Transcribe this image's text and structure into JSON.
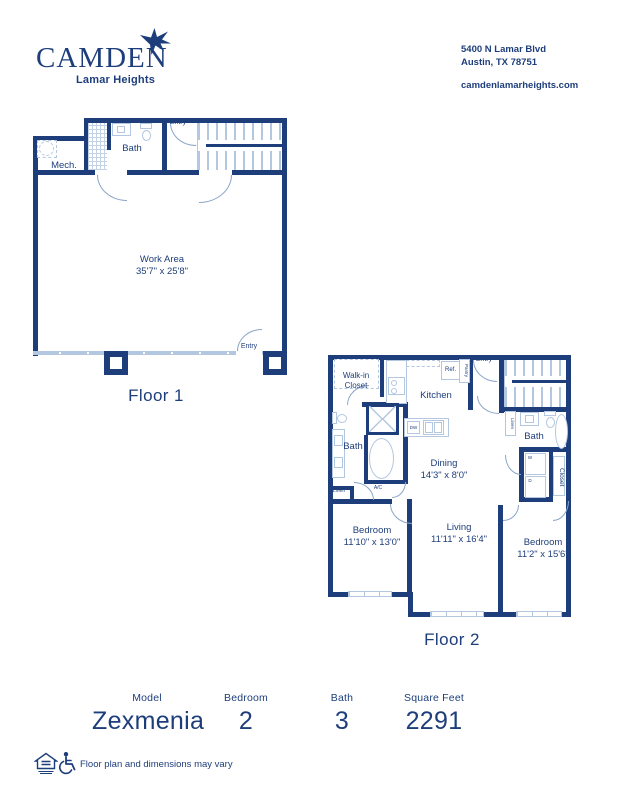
{
  "header": {
    "brand": "CAMDEN",
    "community": "Lamar Heights",
    "address_line1": "5400 N Lamar Blvd",
    "address_line2": "Austin, TX 78751",
    "website": "camdenlamarheights.com"
  },
  "floor1": {
    "title": "Floor 1",
    "mech": "Mech.",
    "bath": "Bath",
    "entry_top": "Entry",
    "entry_bottom": "Entry",
    "work_area_name": "Work Area",
    "work_area_dims": "35'7\" x 25'8\""
  },
  "floor2": {
    "title": "Floor 2",
    "walkin_line1": "Walk-in",
    "walkin_line2": "Closet",
    "kitchen": "Kitchen",
    "ref": "Ref.",
    "pantry": "Pantry",
    "entry": "Entry",
    "bath_left": "Bath",
    "bath_right": "Bath",
    "linen_left": "Linen",
    "linen_right": "Linen",
    "ac": "A/C",
    "dw": "DW",
    "washer": "W",
    "dryer": "D",
    "closet": "Closet",
    "dining_name": "Dining",
    "dining_dims": "14'3\" x 8'0\"",
    "living_name": "Living",
    "living_dims": "11'11\" x 16'4\"",
    "bedroom1_name": "Bedroom",
    "bedroom1_dims": "11'10\" x 13'0\"",
    "bedroom2_name": "Bedroom",
    "bedroom2_dims": "11'2\" x 15'6\""
  },
  "summary": {
    "model_label": "Model",
    "model_value": "Zexmenia",
    "bedroom_label": "Bedroom",
    "bedroom_value": "2",
    "bath_label": "Bath",
    "bath_value": "3",
    "sqft_label": "Square Feet",
    "sqft_value": "2291"
  },
  "footer": {
    "disclaimer": "Floor plan and dimensions may vary"
  },
  "colors": {
    "navy": "#1e3e7b",
    "light": "#b3c7e0",
    "mid": "#8aa5c8"
  }
}
